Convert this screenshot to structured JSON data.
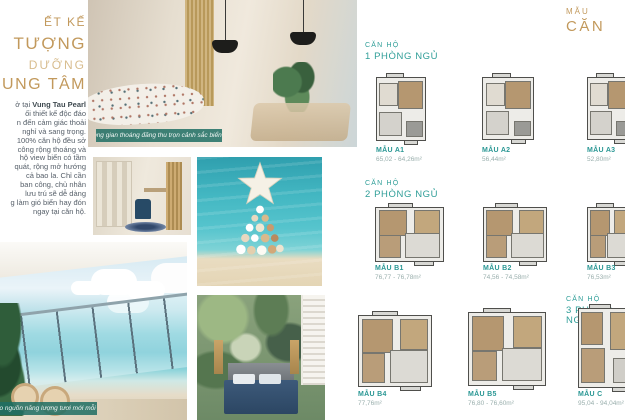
{
  "left_column": {
    "title_lines": [
      "ẾT KẾ",
      "TƯỢNG",
      "DƯỠNG",
      "UNG TÂM"
    ],
    "intro_prefix": "ở tại",
    "brand": "Vung Tau Pearl",
    "paragraph_lines": [
      "ối thiết kế độc đáo",
      "n đến cảm giác thoải",
      "nghỉ và sang trọng.",
      "100% căn hộ đều sở",
      "công rộng thoáng và",
      "hộ view biển có tầm",
      "quát, rộng mở hướng",
      "cả bao la. Chỉ cần",
      "ban công, chủ nhân",
      "lưu trú sẽ dễ dàng",
      "g làm gió biển hay đón",
      "ngay tại căn hộ."
    ]
  },
  "photos": {
    "living_caption": "Không gian thoáng đãng thu trọn cảnh sắc biển trời",
    "balcony_caption": "tái tạo nguồn năng lượng tươi mới mỗi ngày"
  },
  "right_panel": {
    "header_small": "MẪU",
    "header_large": "CĂN",
    "sections": [
      {
        "line1": "CĂN HỘ",
        "line2": "1 PHÒNG NGỦ",
        "plans": [
          {
            "name": "MẪU A1",
            "area": "65,02 - 64,26m²"
          },
          {
            "name": "MẪU A2",
            "area": "56,44m²"
          },
          {
            "name": "MẪU A3",
            "area": "52,80m²"
          }
        ]
      },
      {
        "line1": "CĂN HỘ",
        "line2": "2 PHÒNG NGỦ",
        "plans": [
          {
            "name": "MẪU B1",
            "area": "76,77 - 76,78m²"
          },
          {
            "name": "MẪU B2",
            "area": "74,56 - 74,58m²"
          },
          {
            "name": "MẪU B3",
            "area": "76,53m²"
          }
        ]
      },
      {
        "line1": "CĂN HỘ",
        "line2": "3 PHÒNG NGỦ",
        "plans": [
          {
            "name": "MẪU B4",
            "area": "77,76m²"
          },
          {
            "name": "MẪU B5",
            "area": "76,80 - 76,60m²"
          },
          {
            "name": "MẪU C",
            "area": "95,04 - 94,04m²"
          }
        ]
      }
    ]
  },
  "colors": {
    "gold": "#c2995c",
    "gold_light": "#d8bd8f",
    "teal": "#2f9e98",
    "caption_teal": "#1e6e64",
    "body_text": "#57606a"
  }
}
